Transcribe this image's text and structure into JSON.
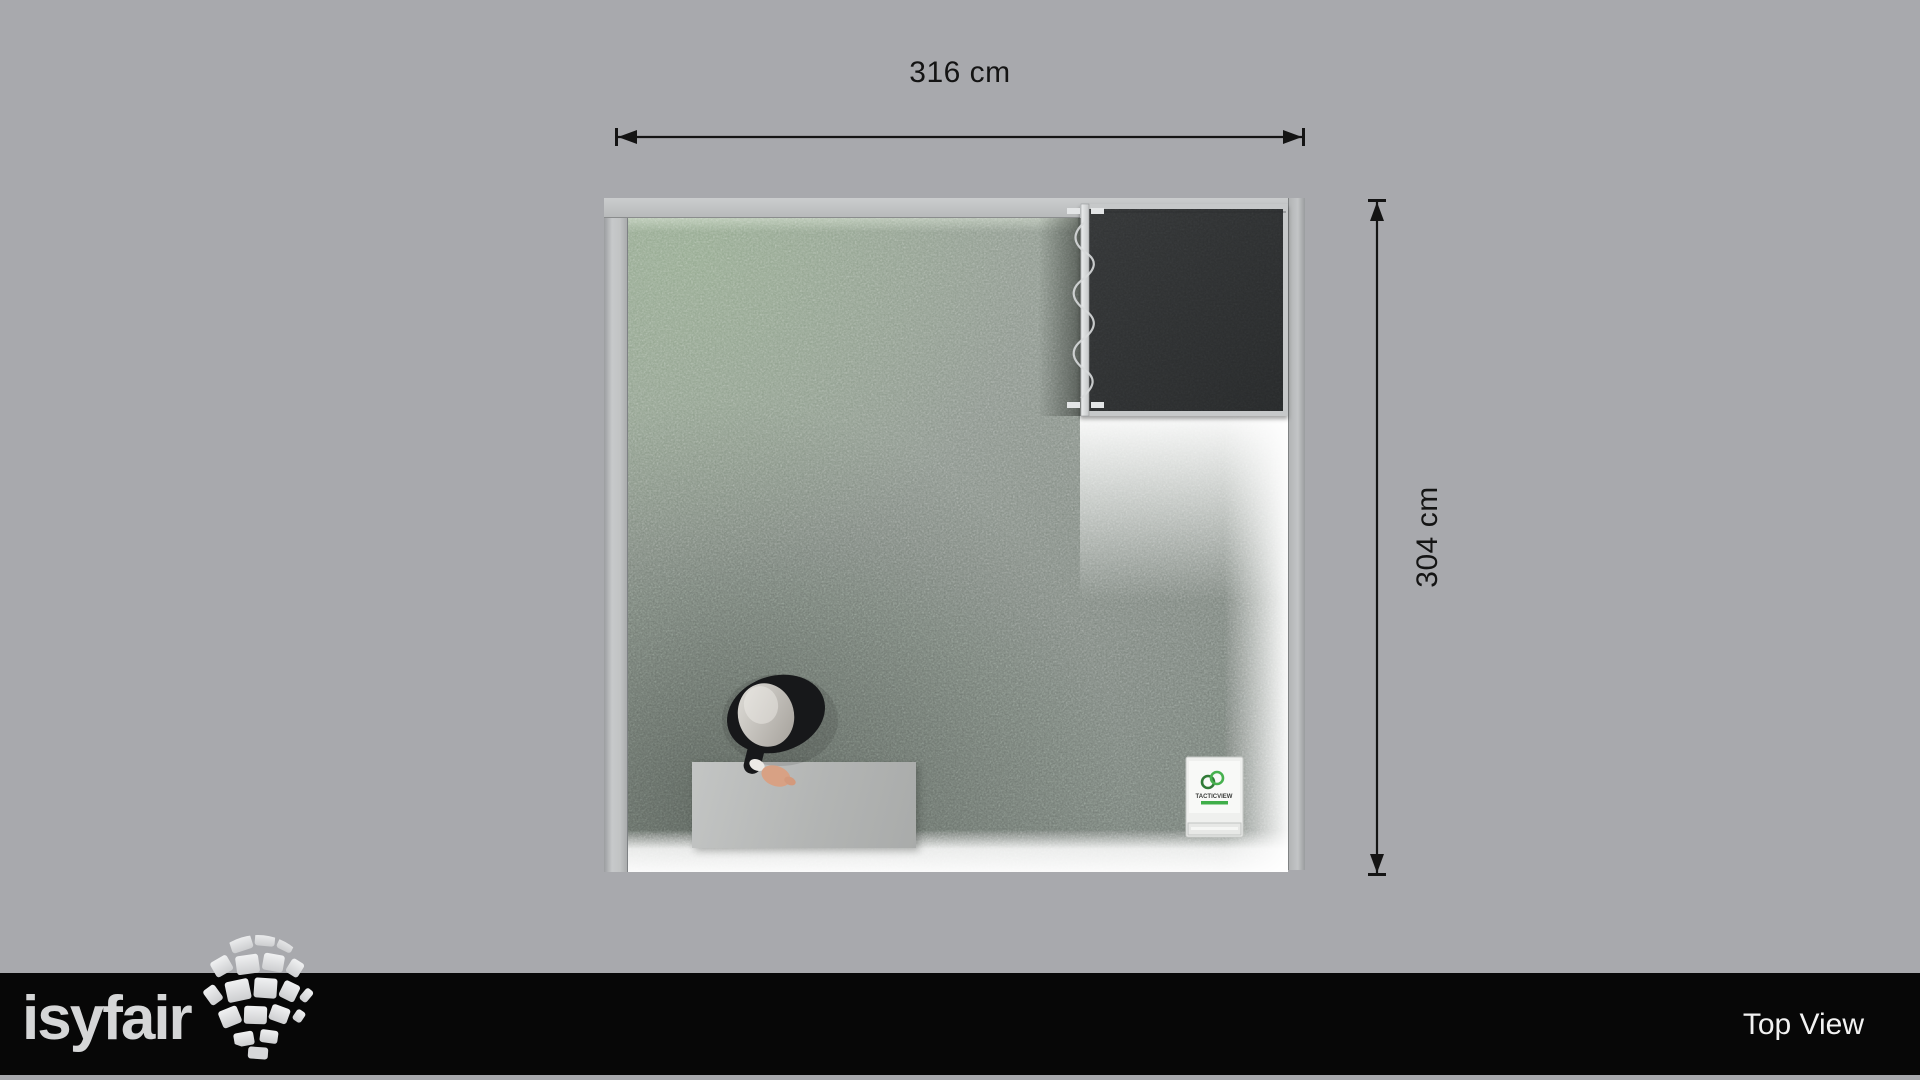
{
  "colors": {
    "background": "#a8a9ad",
    "footer_bg": "#070707",
    "text_dark": "#141414",
    "text_light": "#f2f2f2",
    "logo_gray": "#d5d6d7",
    "carpet_base": "#8e978f",
    "dark_room_fabric": "#2d2f30",
    "wall_gray": "#c6c8c9",
    "led_glow": "#ffffff",
    "accent_green": "#3fae49",
    "skin_tone": "#d8a184"
  },
  "annotations": {
    "width_label": "316 cm",
    "height_label": "304 cm"
  },
  "booth": {
    "sign_brand": "TACTICVIEW"
  },
  "footer": {
    "brand": "isyfair",
    "view_label": "Top View"
  }
}
